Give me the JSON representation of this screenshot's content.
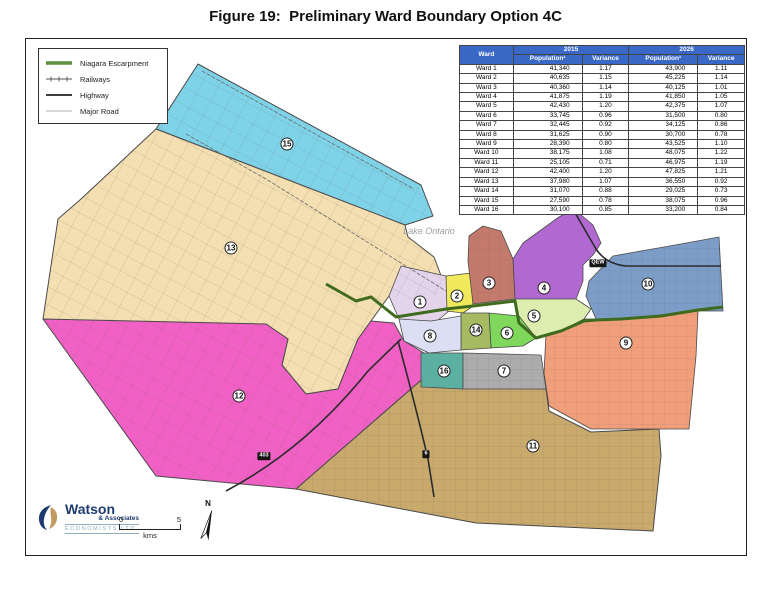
{
  "title": "Figure 19:  Preliminary Ward Boundary Option 4C",
  "legend": {
    "items": [
      {
        "label": "Niagara Escarpment",
        "symbol": "escarpment-line",
        "color": "#5D9140"
      },
      {
        "label": "Railways",
        "symbol": "railway-line",
        "color": "#555555"
      },
      {
        "label": "Highway",
        "symbol": "highway-line",
        "color": "#222222"
      },
      {
        "label": "Major Road",
        "symbol": "major-road-line",
        "color": "#999999"
      }
    ]
  },
  "table": {
    "header_bg": "#3A68C6",
    "header": {
      "ward": "Ward",
      "year_2015": "2015",
      "year_2026": "2026",
      "population": "Population¹",
      "variance": "Variance"
    },
    "rows": [
      {
        "ward": "Ward 1",
        "pop_2015": "41,340",
        "var_2015": "1.17",
        "pop_2026": "43,900",
        "var_2026": "1.11"
      },
      {
        "ward": "Ward 2",
        "pop_2015": "40,635",
        "var_2015": "1.15",
        "pop_2026": "45,225",
        "var_2026": "1.14"
      },
      {
        "ward": "Ward 3",
        "pop_2015": "40,360",
        "var_2015": "1.14",
        "pop_2026": "40,125",
        "var_2026": "1.01"
      },
      {
        "ward": "Ward 4",
        "pop_2015": "41,875",
        "var_2015": "1.19",
        "pop_2026": "41,850",
        "var_2026": "1.05"
      },
      {
        "ward": "Ward 5",
        "pop_2015": "42,430",
        "var_2015": "1.20",
        "pop_2026": "42,375",
        "var_2026": "1.07"
      },
      {
        "ward": "Ward 6",
        "pop_2015": "33,745",
        "var_2015": "0.96",
        "pop_2026": "31,500",
        "var_2026": "0.80"
      },
      {
        "ward": "Ward 7",
        "pop_2015": "32,445",
        "var_2015": "0.92",
        "pop_2026": "34,125",
        "var_2026": "0.86"
      },
      {
        "ward": "Ward 8",
        "pop_2015": "31,625",
        "var_2015": "0.90",
        "pop_2026": "30,700",
        "var_2026": "0.78"
      },
      {
        "ward": "Ward 9",
        "pop_2015": "28,390",
        "var_2015": "0.80",
        "pop_2026": "43,525",
        "var_2026": "1.10"
      },
      {
        "ward": "Ward 10",
        "pop_2015": "38,175",
        "var_2015": "1.08",
        "pop_2026": "48,075",
        "var_2026": "1.22"
      },
      {
        "ward": "Ward 11",
        "pop_2015": "25,105",
        "var_2015": "0.71",
        "pop_2026": "46,975",
        "var_2026": "1.19"
      },
      {
        "ward": "Ward 12",
        "pop_2015": "42,400",
        "var_2015": "1.20",
        "pop_2026": "47,825",
        "var_2026": "1.21"
      },
      {
        "ward": "Ward 13",
        "pop_2015": "37,980",
        "var_2015": "1.07",
        "pop_2026": "36,550",
        "var_2026": "0.92"
      },
      {
        "ward": "Ward 14",
        "pop_2015": "31,070",
        "var_2015": "0.88",
        "pop_2026": "29,025",
        "var_2026": "0.73"
      },
      {
        "ward": "Ward 15",
        "pop_2015": "27,590",
        "var_2015": "0.78",
        "pop_2026": "38,075",
        "var_2026": "0.96"
      },
      {
        "ward": "Ward 16",
        "pop_2015": "30,100",
        "var_2015": "0.85",
        "pop_2026": "33,200",
        "var_2026": "0.84"
      }
    ]
  },
  "map": {
    "lake_label": "Lake Ontario",
    "escarpment_color": "#3E6B1E",
    "wards": [
      {
        "num": 1,
        "color": "#E3D4EB",
        "x": 394,
        "y": 263
      },
      {
        "num": 2,
        "color": "#F1E95C",
        "x": 431,
        "y": 257
      },
      {
        "num": 3,
        "color": "#C47A6B",
        "x": 463,
        "y": 244
      },
      {
        "num": 4,
        "color": "#B168D1",
        "x": 518,
        "y": 249
      },
      {
        "num": 5,
        "color": "#DDEDAF",
        "x": 508,
        "y": 277
      },
      {
        "num": 6,
        "color": "#7FD85C",
        "x": 481,
        "y": 294
      },
      {
        "num": 7,
        "color": "#ACACAC",
        "x": 478,
        "y": 332
      },
      {
        "num": 8,
        "color": "#DCDFF3",
        "x": 404,
        "y": 297
      },
      {
        "num": 9,
        "color": "#F19E7A",
        "x": 600,
        "y": 304
      },
      {
        "num": 10,
        "color": "#7C9DC7",
        "x": 622,
        "y": 245
      },
      {
        "num": 11,
        "color": "#C9A96C",
        "x": 507,
        "y": 407
      },
      {
        "num": 12,
        "color": "#F161C5",
        "x": 213,
        "y": 357
      },
      {
        "num": 13,
        "color": "#F3DFB1",
        "x": 205,
        "y": 209
      },
      {
        "num": 14,
        "color": "#A6BA62",
        "x": 450,
        "y": 291
      },
      {
        "num": 15,
        "color": "#7FD3E9",
        "x": 261,
        "y": 105
      },
      {
        "num": 16,
        "color": "#5BB0A2",
        "x": 418,
        "y": 332
      }
    ],
    "highway_badges": [
      {
        "label": "QEW",
        "x": 572,
        "y": 224
      },
      {
        "label": "403",
        "x": 238,
        "y": 417
      },
      {
        "label": "6",
        "x": 400,
        "y": 415
      }
    ]
  },
  "footer": {
    "logo": {
      "line1": "Watson",
      "line2": "& Associates",
      "line3": "ECONOMISTS LTD."
    },
    "scale": {
      "start": "0",
      "end": "5",
      "unit": "kms"
    },
    "north_label": "N"
  }
}
